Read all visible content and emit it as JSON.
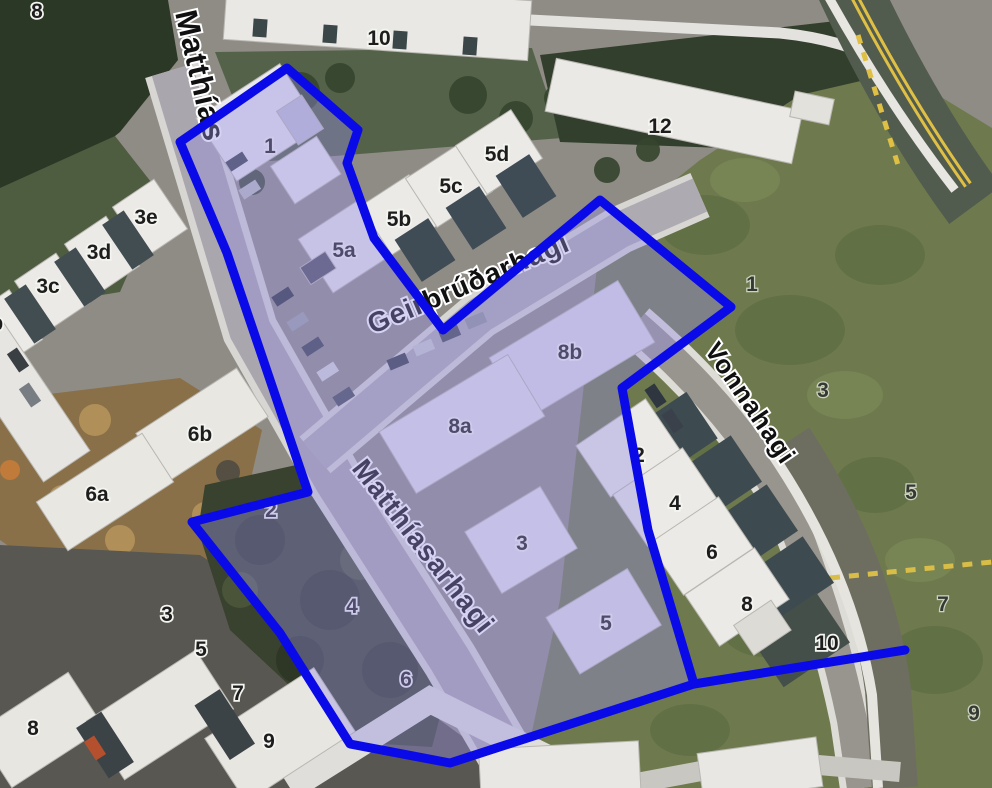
{
  "map": {
    "streets": [
      {
        "name": "Matthías"
      },
      {
        "name": "Geirþrúðarhagi"
      },
      {
        "name": "Matthíasarhagi"
      },
      {
        "name": "Vonnahagi"
      }
    ],
    "number_labels": [
      {
        "text": "8"
      },
      {
        "text": "10"
      },
      {
        "text": "12"
      },
      {
        "text": "1"
      },
      {
        "text": "5a"
      },
      {
        "text": "5b"
      },
      {
        "text": "5c"
      },
      {
        "text": "5d"
      },
      {
        "text": "3e"
      },
      {
        "text": "3d"
      },
      {
        "text": "3c"
      },
      {
        "text": "3b"
      },
      {
        "text": "6b"
      },
      {
        "text": "6a"
      },
      {
        "text": "2"
      },
      {
        "text": "4"
      },
      {
        "text": "6"
      },
      {
        "text": "8a"
      },
      {
        "text": "8b"
      },
      {
        "text": "3"
      },
      {
        "text": "5"
      },
      {
        "text": "2"
      },
      {
        "text": "4"
      },
      {
        "text": "6"
      },
      {
        "text": "8"
      },
      {
        "text": "10"
      },
      {
        "text": "1"
      },
      {
        "text": "3"
      },
      {
        "text": "5"
      },
      {
        "text": "7"
      },
      {
        "text": "9"
      },
      {
        "text": "3"
      },
      {
        "text": "5"
      },
      {
        "text": "7"
      },
      {
        "text": "9"
      },
      {
        "text": "8"
      }
    ],
    "highlight": {
      "stroke_color": "#0a0ae8",
      "fill_color": "#958fe2"
    },
    "road_marking_color": "#dfc045"
  }
}
